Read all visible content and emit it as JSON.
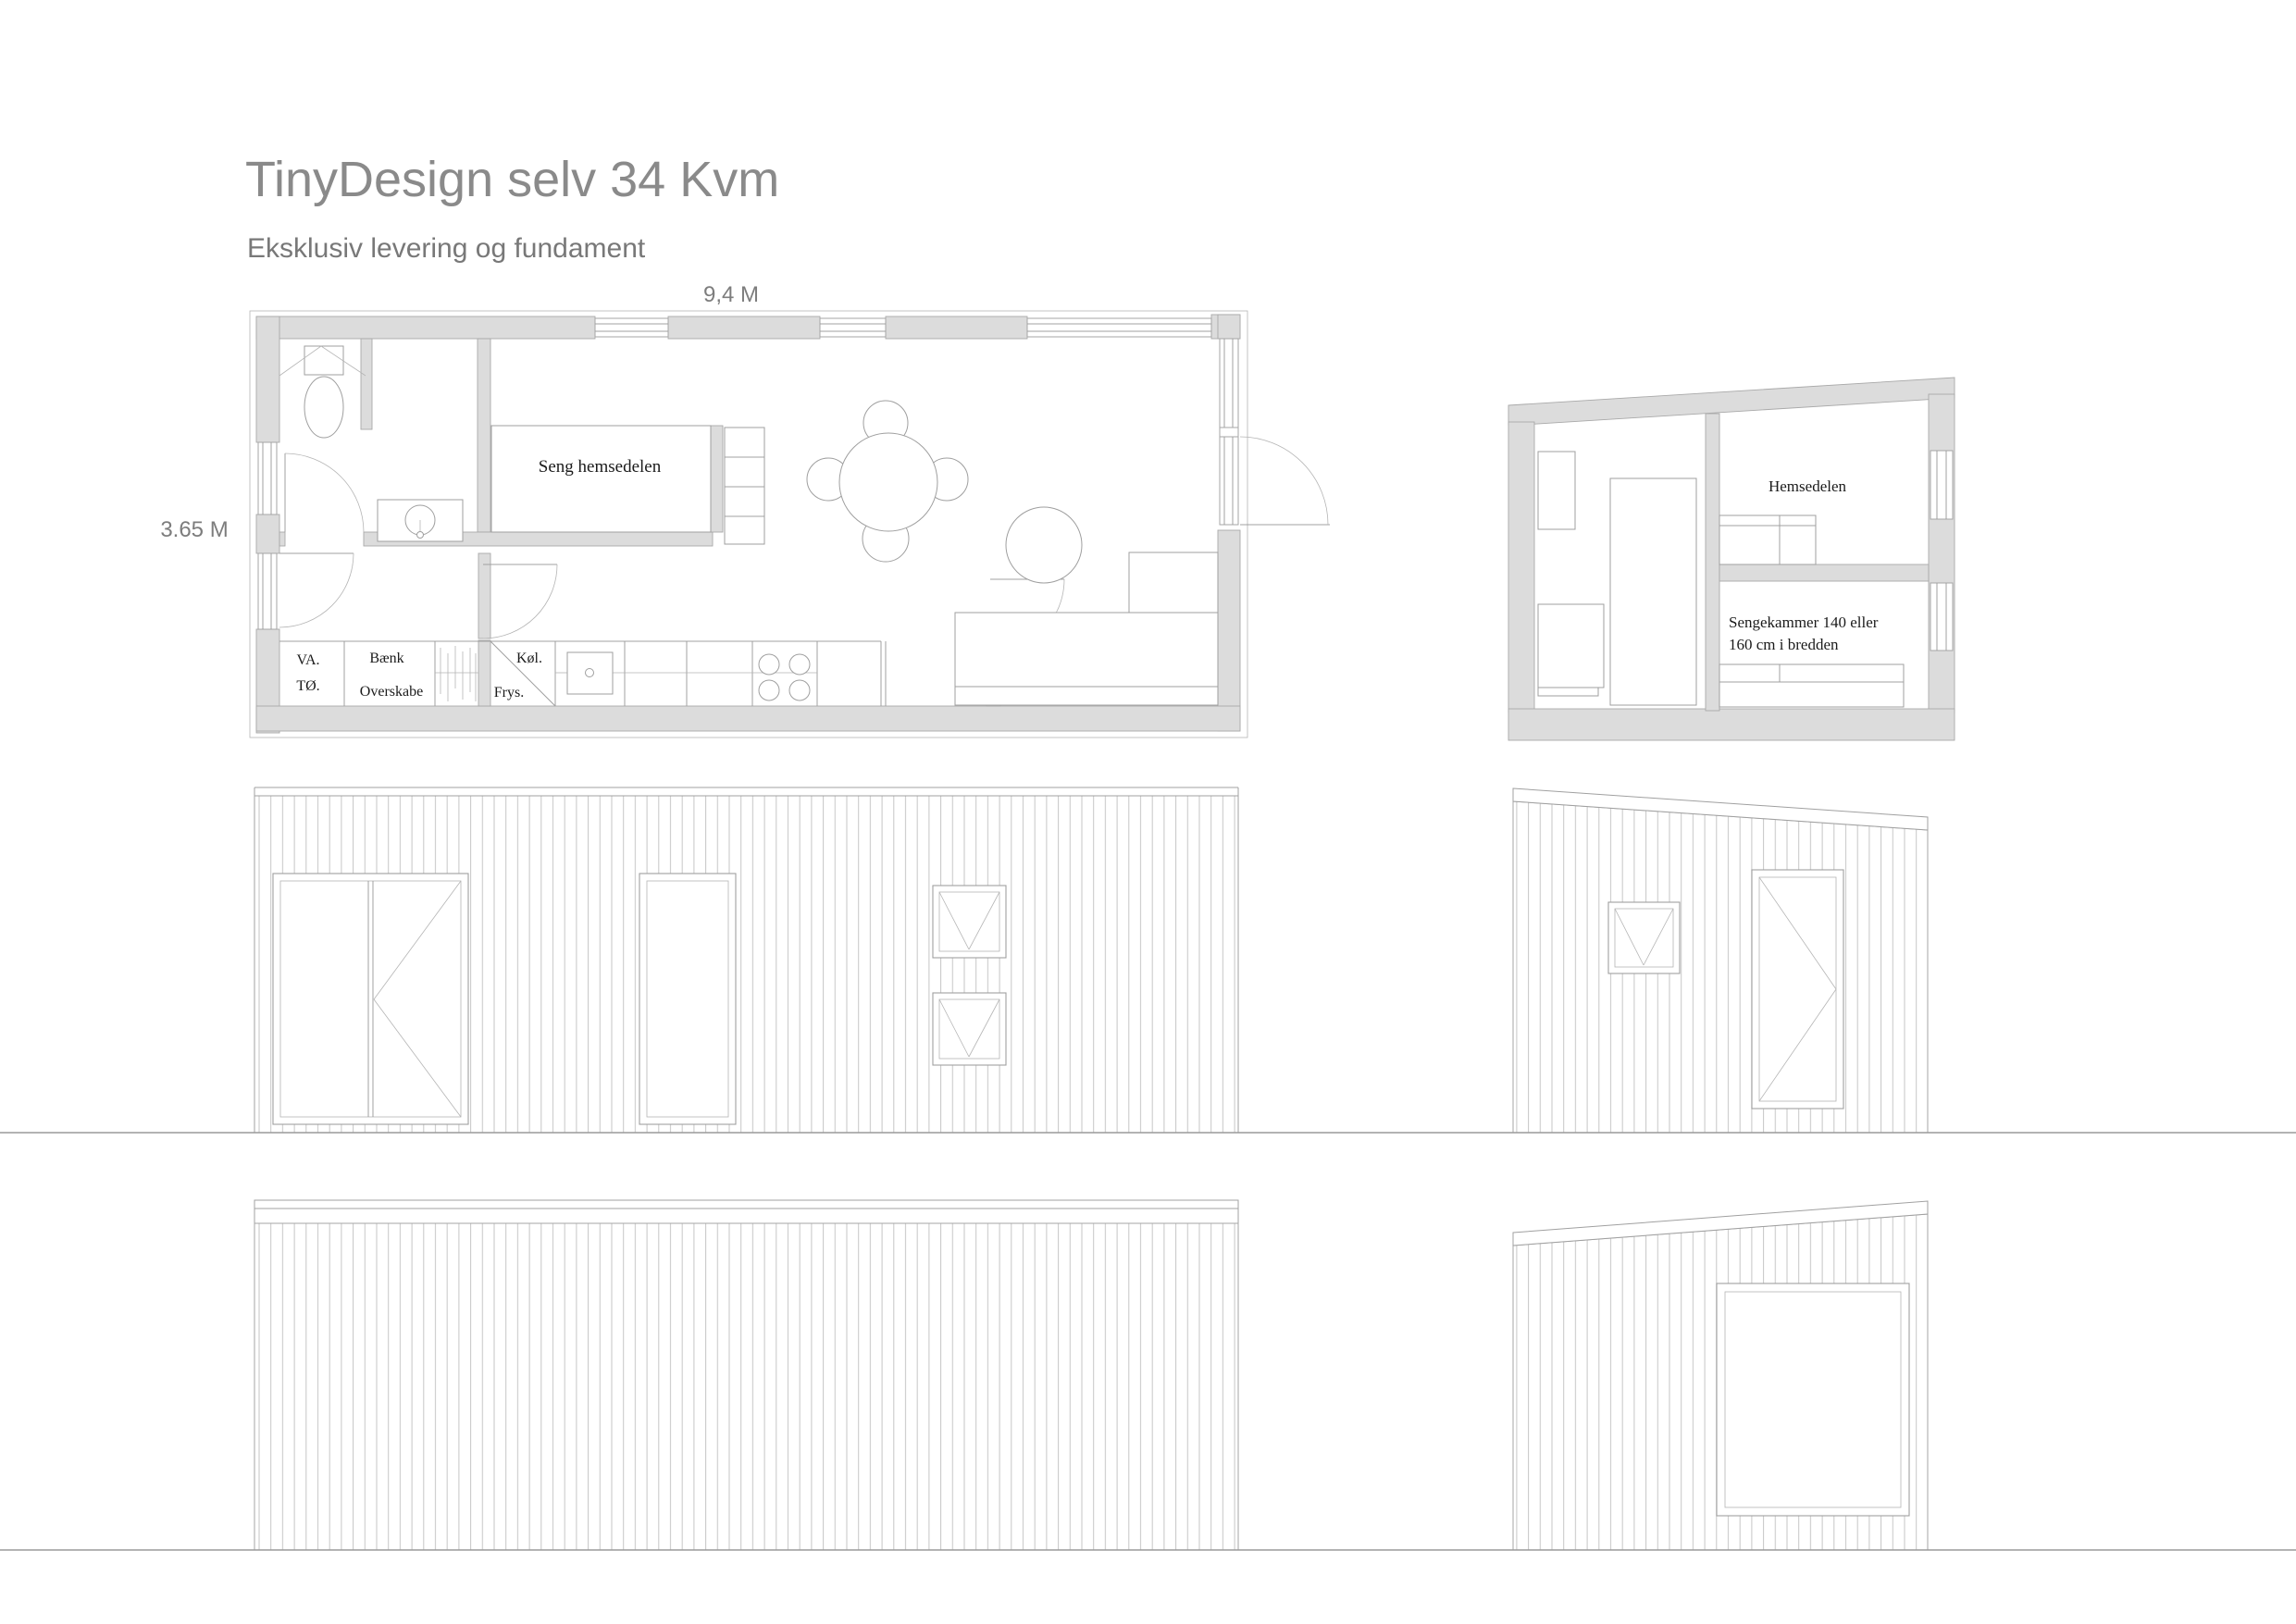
{
  "page": {
    "title": "TinyDesign selv 34 Kvm",
    "subtitle": "Eksklusiv levering og fundament"
  },
  "floor_plan": {
    "width_dimension": "9,4 M",
    "depth_dimension": "3.65 M",
    "bed_label": "Seng hemsedelen",
    "utility_line1": "VA.",
    "utility_line2": "TØ.",
    "bench_label": "Bænk",
    "overhead_cabinet_label": "Overskabe",
    "fridge_label": "Køl.",
    "freezer_label": "Frys."
  },
  "cross_section": {
    "loft_label": "Hemsedelen",
    "bed_chamber_line1": "Sengekammer 140 eller",
    "bed_chamber_line2": "160 cm i bredden"
  },
  "colors": {
    "wall_fill": "#dcdcdc",
    "drawing_line": "#a0a0a0",
    "siding_line": "#c6c6c6",
    "title_text": "#8a8a8a",
    "dimension_text": "#7d7d7d",
    "label_text": "#1b1b1b"
  }
}
